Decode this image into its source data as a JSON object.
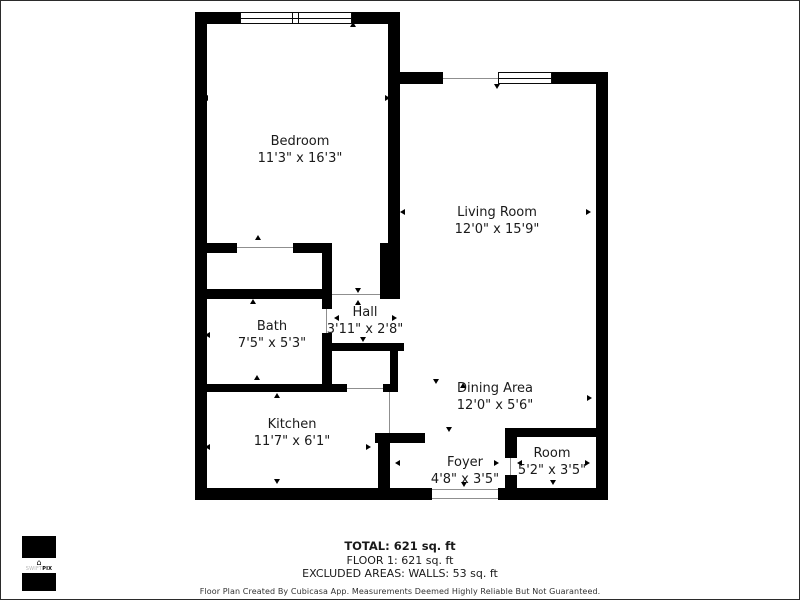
{
  "plan": {
    "rooms": [
      {
        "name": "Bedroom",
        "dims": "11'3\" x 16'3\""
      },
      {
        "name": "Living Room",
        "dims": "12'0\" x 15'9\""
      },
      {
        "name": "Bath",
        "dims": "7'5\" x 5'3\""
      },
      {
        "name": "Hall",
        "dims": "3'11\" x 2'8\""
      },
      {
        "name": "Kitchen",
        "dims": "11'7\" x 6'1\""
      },
      {
        "name": "Dining Area",
        "dims": "12'0\" x 5'6\""
      },
      {
        "name": "Foyer",
        "dims": "4'8\" x 3'5\""
      },
      {
        "name": "Room",
        "dims": "5'2\" x 3'5\""
      }
    ],
    "dimension_arrows": [
      {
        "x": 203,
        "y": 95,
        "d": "left"
      },
      {
        "x": 385,
        "y": 95,
        "d": "right"
      },
      {
        "x": 350,
        "y": 22,
        "d": "up"
      },
      {
        "x": 255,
        "y": 235,
        "d": "up"
      },
      {
        "x": 205,
        "y": 332,
        "d": "left"
      },
      {
        "x": 250,
        "y": 299,
        "d": "up"
      },
      {
        "x": 254,
        "y": 375,
        "d": "up"
      },
      {
        "x": 334,
        "y": 315,
        "d": "left"
      },
      {
        "x": 392,
        "y": 315,
        "d": "right"
      },
      {
        "x": 355,
        "y": 288,
        "d": "down"
      },
      {
        "x": 355,
        "y": 300,
        "d": "up"
      },
      {
        "x": 360,
        "y": 337,
        "d": "down"
      },
      {
        "x": 205,
        "y": 444,
        "d": "left"
      },
      {
        "x": 366,
        "y": 444,
        "d": "right"
      },
      {
        "x": 274,
        "y": 393,
        "d": "up"
      },
      {
        "x": 274,
        "y": 479,
        "d": "down"
      },
      {
        "x": 400,
        "y": 209,
        "d": "left"
      },
      {
        "x": 586,
        "y": 209,
        "d": "right"
      },
      {
        "x": 494,
        "y": 84,
        "d": "down"
      },
      {
        "x": 433,
        "y": 379,
        "d": "down"
      },
      {
        "x": 460,
        "y": 383,
        "d": "up"
      },
      {
        "x": 587,
        "y": 395,
        "d": "right"
      },
      {
        "x": 395,
        "y": 460,
        "d": "left"
      },
      {
        "x": 494,
        "y": 460,
        "d": "right"
      },
      {
        "x": 446,
        "y": 427,
        "d": "down"
      },
      {
        "x": 461,
        "y": 482,
        "d": "down"
      },
      {
        "x": 517,
        "y": 460,
        "d": "left"
      },
      {
        "x": 585,
        "y": 460,
        "d": "right"
      },
      {
        "x": 550,
        "y": 430,
        "d": "up"
      },
      {
        "x": 550,
        "y": 480,
        "d": "down"
      }
    ]
  },
  "summary": {
    "total": "TOTAL: 621 sq. ft",
    "floor": "FLOOR 1: 621 sq. ft",
    "excluded": "EXCLUDED AREAS: WALLS: 53 sq. ft",
    "disclaimer": "Floor Plan Created By Cubicasa App. Measurements Deemed Highly Reliable But Not Guaranteed."
  },
  "logo": {
    "brand_light": "SWIFT",
    "brand_bold": "PIX",
    "icon": "house-icon"
  },
  "colors": {
    "wall": "#000000",
    "background": "#ffffff",
    "text": "#1a1a1a"
  }
}
